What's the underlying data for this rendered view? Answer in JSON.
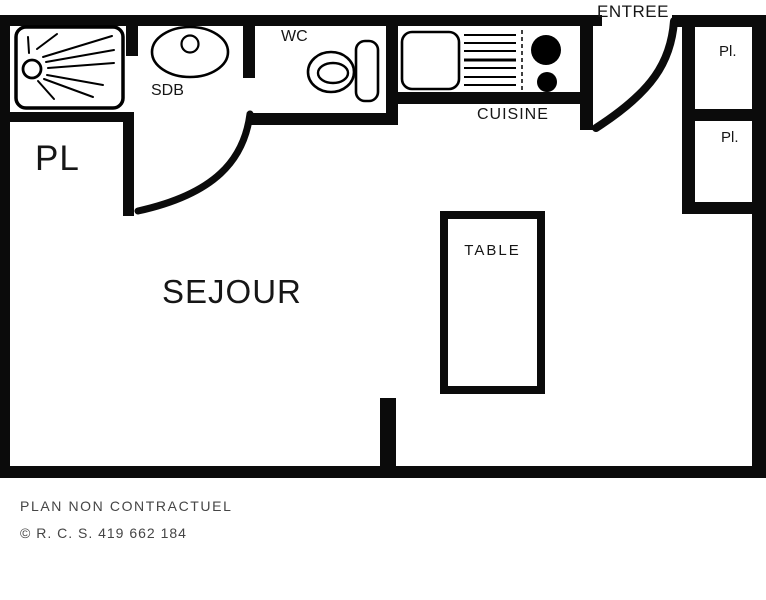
{
  "plan": {
    "room_labels": {
      "sejour": "SEJOUR",
      "closet_left": "PL",
      "bathroom": "SDB",
      "wc": "WC",
      "kitchen": "CUISINE",
      "entrance": "ENTREE",
      "closet_right_top": "Pl.",
      "closet_right_bottom": "Pl.",
      "table": "TABLE"
    },
    "icons": {
      "shower": "shower-tray-icon",
      "washbasin": "washbasin-icon",
      "toilet": "toilet-icon",
      "kitchen_sink": "kitchen-sink-icon",
      "drainer": "drainer-lines-icon",
      "burners": "hob-burners-icon",
      "entry_door": "door-swing-icon",
      "sejour_door": "door-swing-icon"
    },
    "colors": {
      "walls": "#0b0b0b",
      "room_text": "#161616",
      "footer_text": "#454545",
      "background": "#ffffff"
    }
  },
  "footer": {
    "disclaimer": "PLAN NON CONTRACTUEL",
    "registration": "© R. C. S. 419 662 184"
  }
}
